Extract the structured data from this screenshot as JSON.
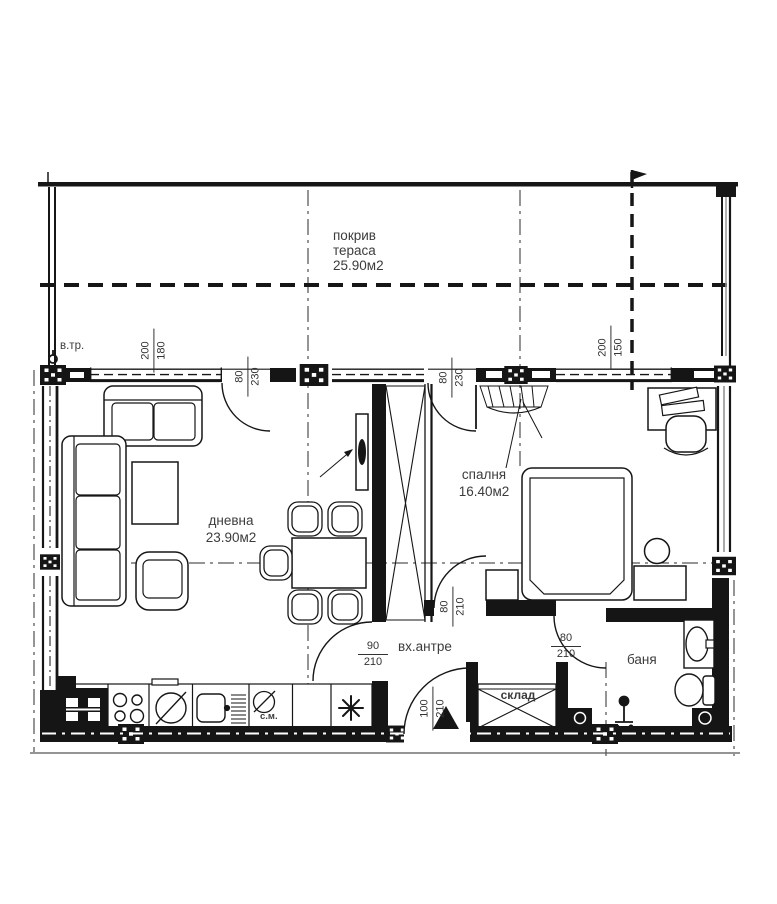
{
  "plan": {
    "title": "apartment-floor-plan",
    "colors": {
      "line": "#161616",
      "text": "#3c3c3c",
      "background": "#ffffff"
    },
    "rooms": {
      "terrace": {
        "line1": "покрив",
        "line2": "тераса",
        "area": "25.90м2"
      },
      "living": {
        "name": "дневна",
        "area": "23.90м2"
      },
      "bedroom": {
        "name": "спалня",
        "area": "16.40м2"
      },
      "hall": {
        "name": "вх.антре"
      },
      "bath": {
        "name": "баня"
      },
      "storage": {
        "name": "склад"
      }
    },
    "annotations": {
      "vent_pipe": "в.тр.",
      "washing_machine": "с.м.",
      "boiler_symbol_icon": "✱"
    },
    "dimensions": {
      "living_terrace_window": {
        "w": "200",
        "h": "180"
      },
      "living_terrace_door": {
        "w": "80",
        "h": "230"
      },
      "bedroom_terrace_door": {
        "w": "80",
        "h": "230"
      },
      "bedroom_window": {
        "w": "200",
        "h": "150"
      },
      "living_hall_door": {
        "w": "90",
        "h": "210"
      },
      "bedroom_door": {
        "w": "80",
        "h": "210"
      },
      "bath_door": {
        "w": "80",
        "h": "210"
      },
      "entrance_door": {
        "w": "100",
        "h": "210"
      }
    }
  }
}
